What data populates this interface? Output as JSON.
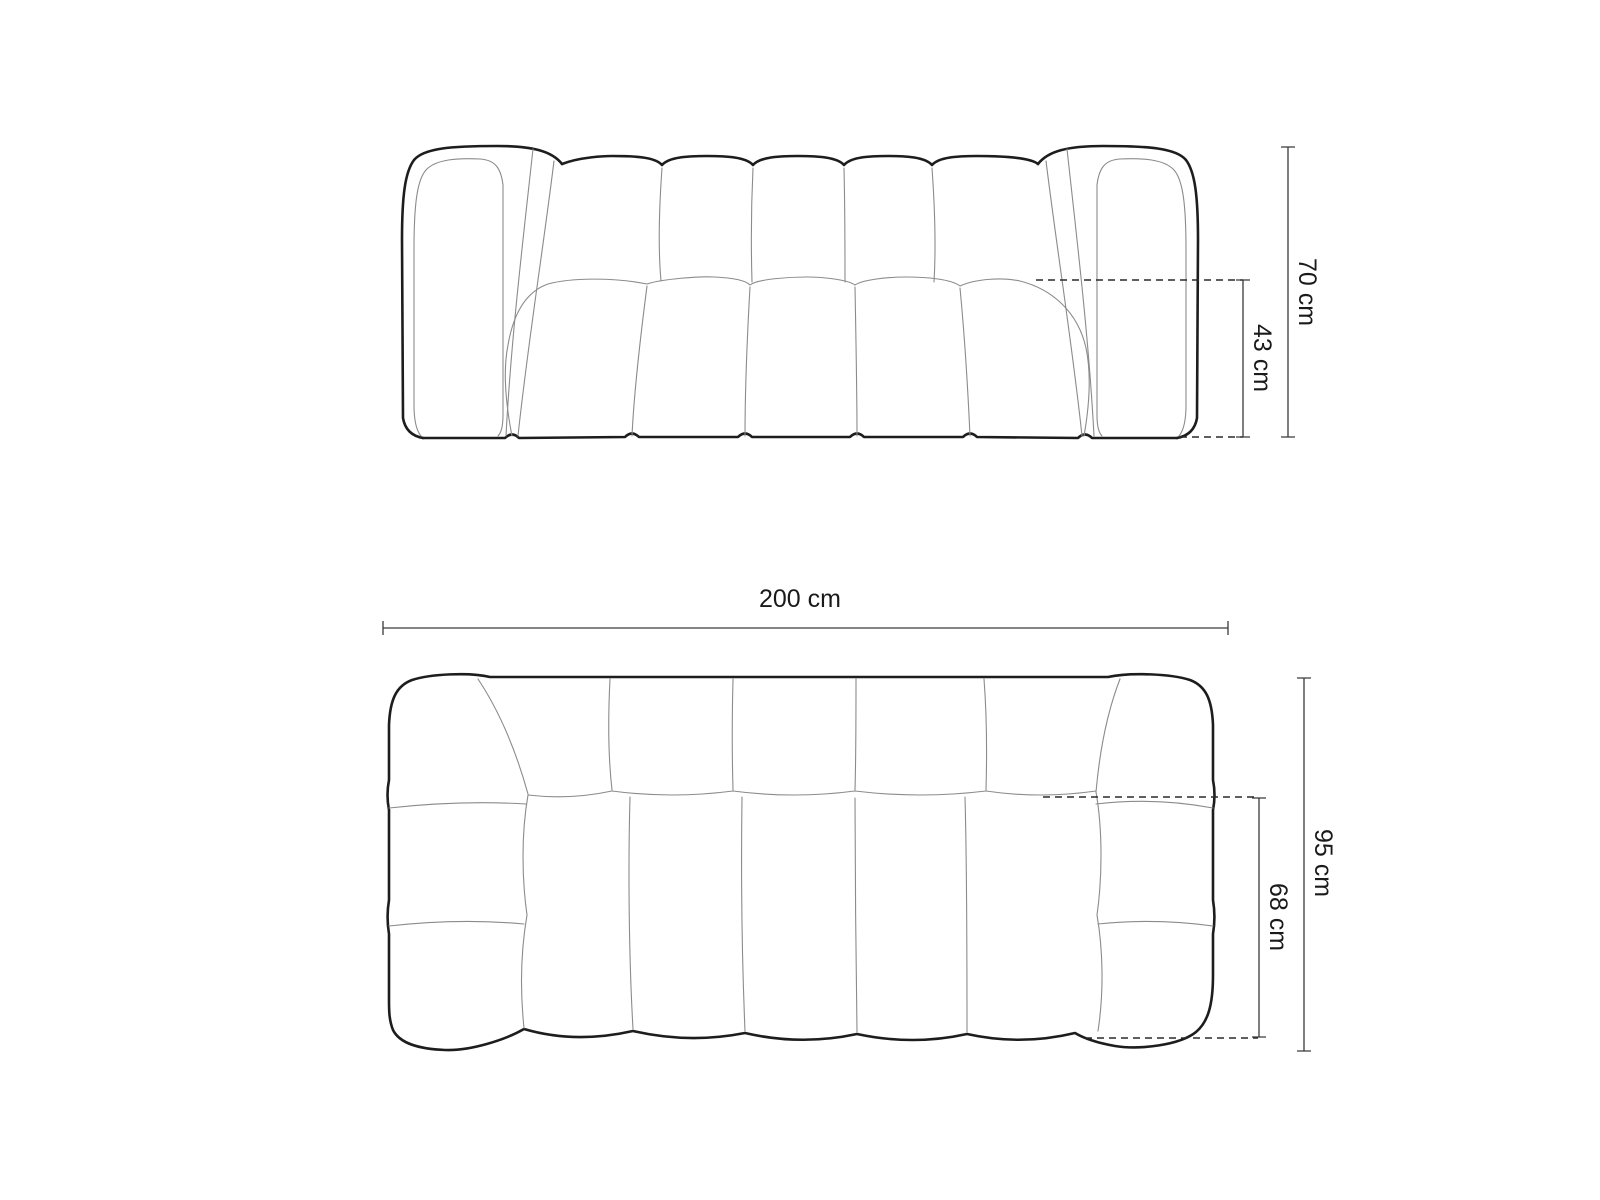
{
  "colors": {
    "background": "#ffffff",
    "outline": "#1d1d1d",
    "contour": "#8b8b8b",
    "dimension_line": "#3a3a3a",
    "label_text": "#1a1a1a"
  },
  "dimensions": {
    "front_total_height": "70 cm",
    "front_seat_height": "43 cm",
    "plan_width": "200 cm",
    "plan_total_depth": "95 cm",
    "plan_seat_depth": "68 cm"
  }
}
